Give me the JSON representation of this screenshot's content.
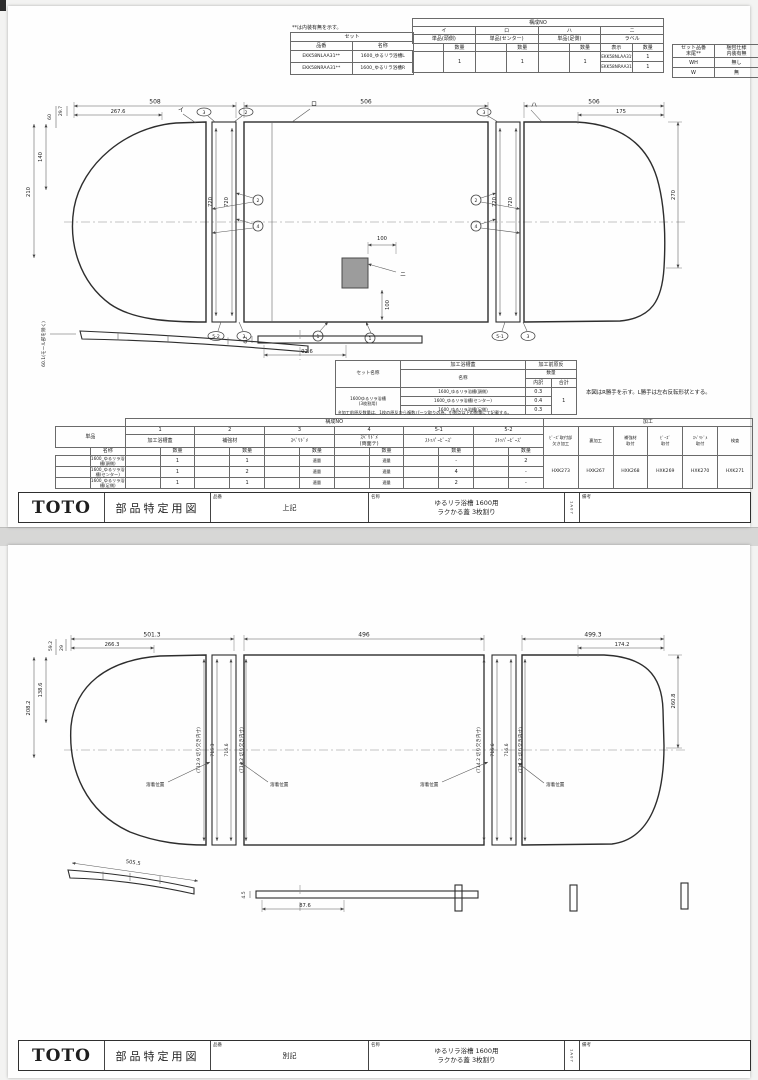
{
  "sheet1": {
    "note_top": "**は内装有無を示す。",
    "set_table": {
      "title": "セット",
      "col1": "品番",
      "col2": "名称",
      "rows": [
        {
          "hinban": "EKK58NLAA31**",
          "name": "1600_ゆるリラ浴槽L"
        },
        {
          "hinban": "EKK58NRAA31**",
          "name": "1600_ゆるリラ浴槽R"
        }
      ]
    },
    "config_table": {
      "title": "構成NO",
      "qty": "数量",
      "hyoji": "表示",
      "g1": {
        "no": "イ",
        "label": "単品(頭側)",
        "qty": "1"
      },
      "g2": {
        "no": "ロ",
        "label": "単品(センター)",
        "qty": "1"
      },
      "g3": {
        "no": "ハ",
        "label": "単品(足側)",
        "qty": "1"
      },
      "g4": {
        "no": "ニ",
        "label": "ラベル",
        "rows": [
          {
            "v": "EKK58NLAA31**",
            "q": "1"
          },
          {
            "v": "EKK58NRAA31**",
            "q": "1"
          }
        ]
      }
    },
    "pack_table": {
      "col1": "セット品番\n末尾**",
      "col2": "梱包仕様\n内装有無",
      "rows": [
        {
          "a": "WH",
          "b": "無し"
        },
        {
          "a": "W",
          "b": "無"
        }
      ]
    },
    "proc_table": {
      "col_set": "セット名称",
      "band1": "加工浴槽蓋",
      "band2": "加工前原反",
      "col_name": "名称",
      "qty": "数量",
      "uchiwake": "内訳",
      "gokei": "合計",
      "set_name": "1600ゆるリラ浴槽\n(3枚割用)",
      "rows": [
        {
          "name": "1600_ゆるリラ浴槽(頭側)",
          "q": "0.3"
        },
        {
          "name": "1600_ゆるリラ浴槽(センター)",
          "q": "0.4"
        },
        {
          "name": "1600_ゆるリラ浴槽(足側)",
          "q": "0.3"
        }
      ],
      "total": "1",
      "note": "※加工前原反数量は、1枚の原反から複数パーツ取りの為、小数点以下の数量にて記載する。"
    },
    "mirror_note": "本図はR勝手を示す。L勝手は左右反転形状とする。",
    "bom": {
      "title": "構成NO",
      "kakou": "加工",
      "tanpin": "単品",
      "meisho": "名称",
      "qty": "数量",
      "c1": "1",
      "c1l": "加工浴槽蓋",
      "c2": "2",
      "c2l": "補強材",
      "c3": "3",
      "c3l": "ｽﾍﾞﾘﾄﾞﾒ",
      "c4": "4",
      "c4l": "ｽﾍﾞﾘﾄﾞﾒ\n(両面テ)",
      "c51": "5-1",
      "c51l": "ｽﾄｯﾊﾟｰﾋﾞｰｽﾞ",
      "c52": "5-2",
      "c52l": "ｽﾄｯﾊﾟｰﾋﾞｰｽﾞ",
      "p1": "ﾋﾞｰｽﾞ取付部\n欠き加工",
      "p2": "裏加工",
      "p3": "補強材\n取付",
      "p4": "ﾋﾞｰｽﾞ\n取付",
      "p5": "ｽﾍﾞﾘﾄﾞﾒ\n取付",
      "p6": "検査",
      "code1": "HXK273",
      "code2": "HXK267",
      "code3": "HXK268",
      "code4": "HXK269",
      "code5": "HXK270",
      "code6": "HXK271",
      "rows": [
        {
          "name": "1600_ゆるリラ浴槽(頭側)",
          "v1": "1",
          "v2": "1",
          "v3": "適量",
          "v4": "適量",
          "v5": "-",
          "v6": "2"
        },
        {
          "name": "1600_ゆるリラ浴槽(センター)",
          "v1": "1",
          "v2": "2",
          "v3": "適量",
          "v4": "適量",
          "v5": "4",
          "v6": "-"
        },
        {
          "name": "1600_ゆるリラ浴槽(足側)",
          "v1": "1",
          "v2": "1",
          "v3": "適量",
          "v4": "適量",
          "v5": "2",
          "v6": "-"
        }
      ]
    },
    "dims": {
      "d508": "508",
      "d2676": "267.6",
      "d60": "60",
      "d297": "29.7",
      "d140": "140",
      "d210": "210",
      "d506": "506",
      "d175": "175",
      "d270": "270",
      "d720": "720",
      "d100": "100",
      "d601": "60.1(モール部を除く)",
      "d62": "6.2",
      "d926": "92.6"
    },
    "marks": {
      "i": "イ",
      "ro": "ロ",
      "ha": "ハ",
      "ni": "ニ",
      "m1": "1",
      "m2": "2",
      "m3": "3",
      "m4": "4",
      "m51": "5-1",
      "m52": "5-2"
    },
    "title_block": {
      "logo": "TOTO",
      "doc": "部品特定用図",
      "hinban_label": "品番",
      "hinban": "上記",
      "name_label": "名称",
      "name1": "ゆるリラ浴槽  1600用",
      "name2": "ラクかる蓋  3枚割り",
      "rev": "1A07",
      "biko": "備考"
    }
  },
  "sheet2": {
    "dims": {
      "d5013": "501.3",
      "d2663": "266.3",
      "d592": "59.2",
      "d29": "29",
      "d1386": "138.6",
      "d2082": "208.2",
      "d496": "496",
      "d4993": "499.3",
      "d1742": "174.2",
      "d2608": "260.8",
      "d5055": "505.5",
      "d45": "4.5",
      "d876": "87.6",
      "cutA": "(712.9 切り欠き内寸)",
      "cutB": "(714.2 切り欠き内寸)",
      "h7153": "715.3",
      "h7166": "716.6"
    },
    "labels": {
      "weld": "溶着位置"
    },
    "title_block": {
      "logo": "TOTO",
      "doc": "部品特定用図",
      "hinban_label": "品番",
      "hinban": "別記",
      "name_label": "名称",
      "name1": "ゆるリラ浴槽  1600用",
      "name2": "ラクかる蓋  3枚割り",
      "rev": "1A07",
      "biko": "備考"
    }
  }
}
